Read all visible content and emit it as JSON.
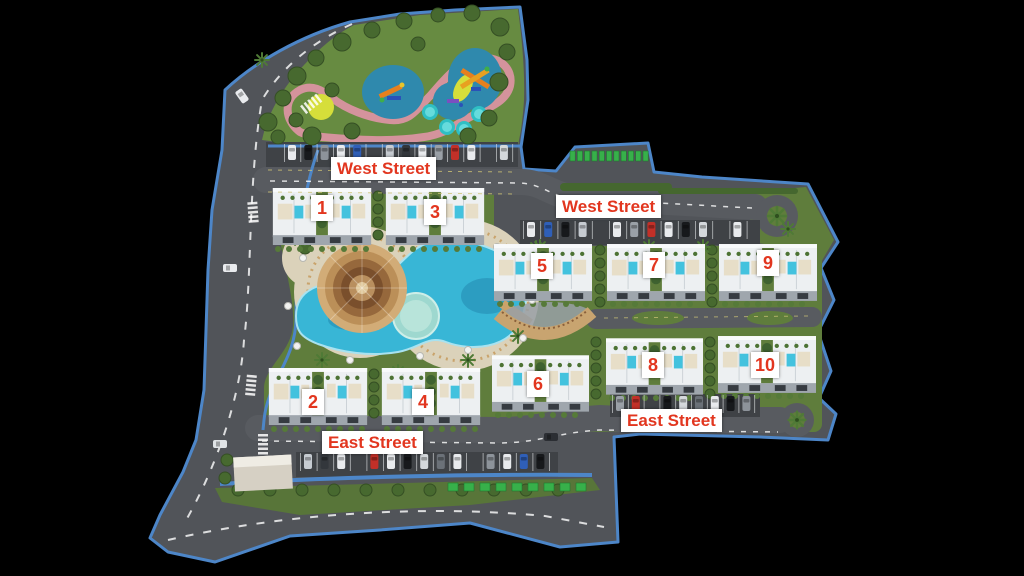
{
  "streets": {
    "west_left": "West Street",
    "west_right": "West Street",
    "east_left": "East Street",
    "east_right": "East Street"
  },
  "buildings": [
    {
      "number": "1"
    },
    {
      "number": "2"
    },
    {
      "number": "3"
    },
    {
      "number": "4"
    },
    {
      "number": "5"
    },
    {
      "number": "6"
    },
    {
      "number": "7"
    },
    {
      "number": "8"
    },
    {
      "number": "9"
    },
    {
      "number": "10"
    }
  ],
  "colors": {
    "background": "#000000",
    "label_text": "#e2361f",
    "label_background": "#ffffff",
    "boundary_blue": "#4d86c8",
    "road_gray": "#515459",
    "grass_green": "#5f7d3c",
    "pool_cyan": "#38b6d6",
    "deck_beige": "#dbd2ba",
    "path_pink": "#d4939c",
    "green_parking": "#37b04a"
  }
}
